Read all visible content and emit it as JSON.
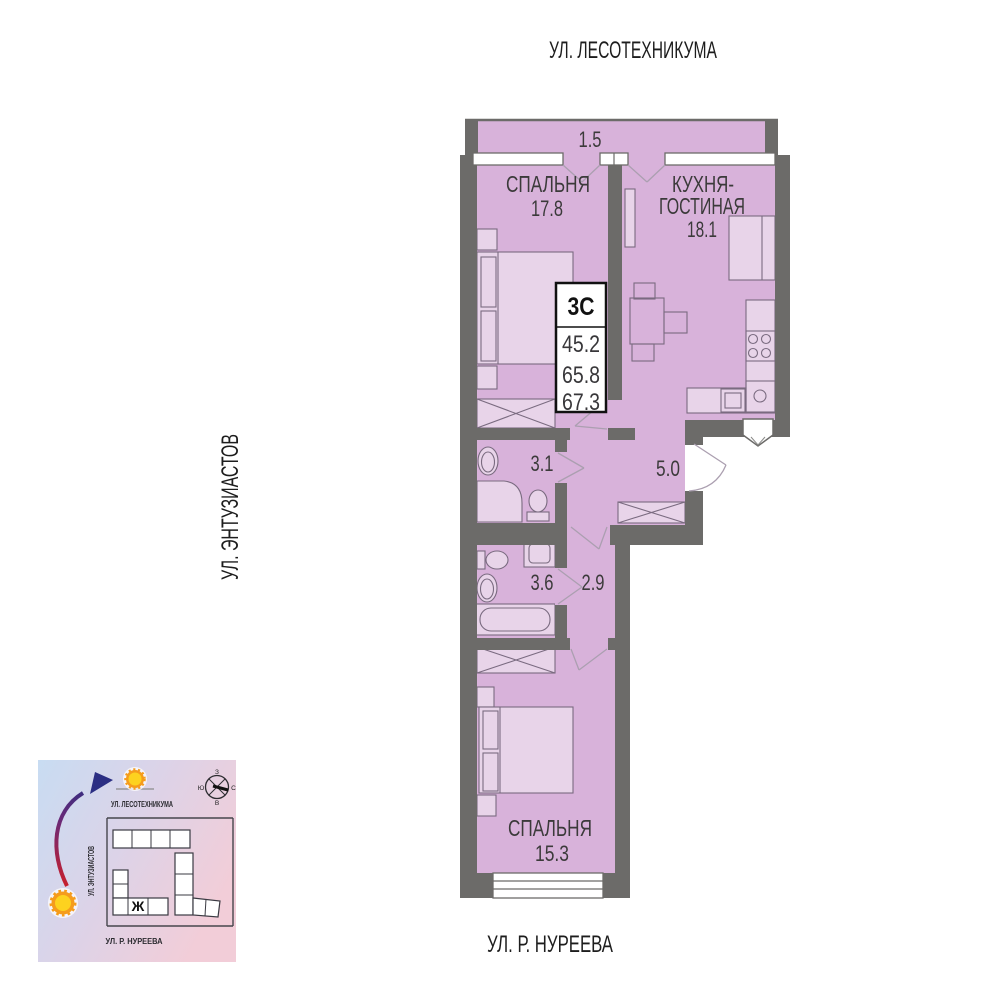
{
  "streets": {
    "top": "УЛ. ЛЕСОТЕХНИКУМА",
    "left": "УЛ. ЭНТУЗИАСТОВ",
    "bottom": "УЛ. Р. НУРЕЕВА"
  },
  "info_box": {
    "type_label": "3С",
    "area_living": "45.2",
    "area_main": "65.8",
    "area_total": "67.3"
  },
  "rooms": {
    "balcony": {
      "area": "1.5"
    },
    "bedroom1": {
      "name": "СПАЛЬНЯ",
      "area": "17.8"
    },
    "kitchen": {
      "name_line1": "КУХНЯ-",
      "name_line2": "ГОСТИНАЯ",
      "area": "18.1"
    },
    "bathroom1": {
      "area": "3.1"
    },
    "hallway": {
      "area": "5.0"
    },
    "bathroom2": {
      "area": "3.6"
    },
    "corridor": {
      "area": "2.9"
    },
    "bedroom2": {
      "name": "СПАЛЬНЯ",
      "area": "15.3"
    }
  },
  "minimap": {
    "streets": {
      "top": "УЛ. ЛЕСОТЕХНИКУМА",
      "left": "УЛ. ЭНТУЗИАСТОВ",
      "bottom": "УЛ. Р. НУРЕЕВА"
    },
    "building_label": "Ж",
    "compass": {
      "top": "З",
      "left": "Ю",
      "right": "С",
      "bottom": "В"
    }
  },
  "colors": {
    "room_fill": "#d8b2da",
    "wall": "#6c6b69",
    "map_blue": "#c8dcf2",
    "map_pink": "#f2cdd8",
    "arrow_red": "#c61f2e",
    "arrow_blue": "#2b2e83",
    "sun_orange": "#f59c1c",
    "sun_yellow": "#fdd21f"
  }
}
